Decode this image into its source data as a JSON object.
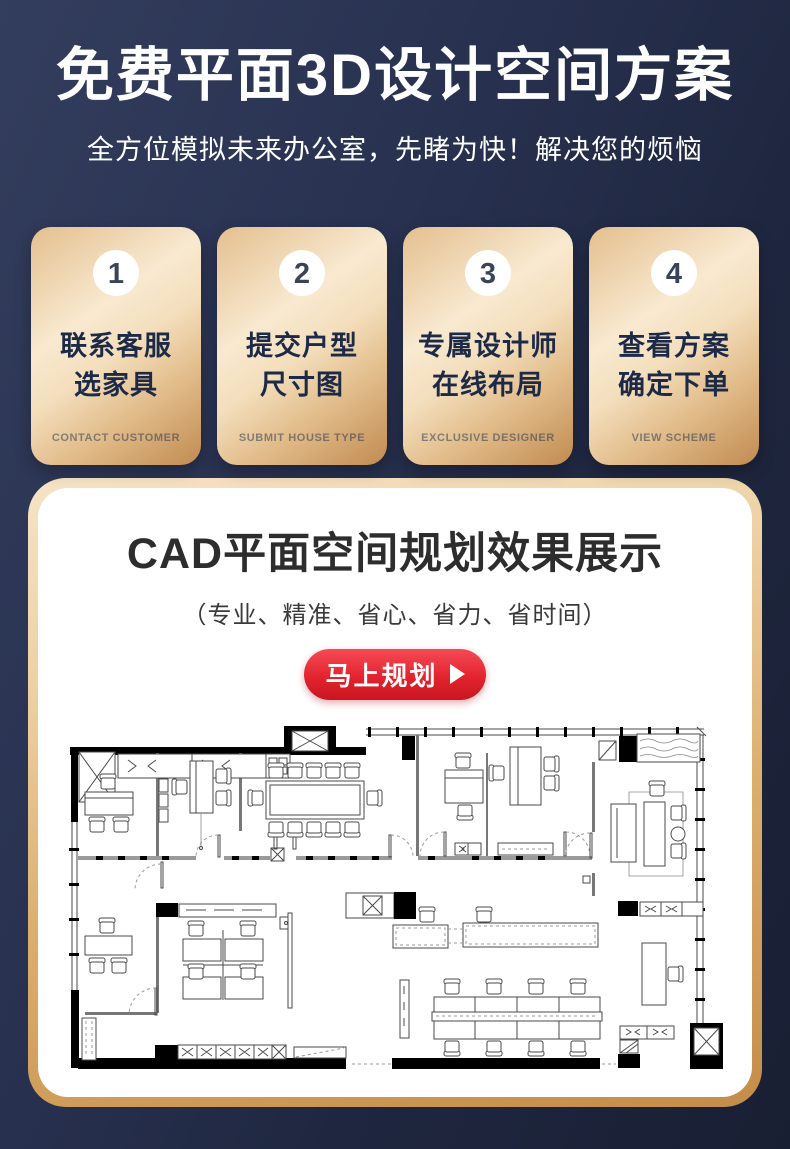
{
  "header": {
    "title": "免费平面3D设计空间方案",
    "subtitle": "全方位模拟未来办公室，先睹为快！解决您的烦恼"
  },
  "steps": {
    "items": [
      {
        "number": "1",
        "line1": "联系客服",
        "line2": "选家具",
        "subtitle": "CONTACT CUSTOMER"
      },
      {
        "number": "2",
        "line1": "提交户型",
        "line2": "尺寸图",
        "subtitle": "SUBMIT HOUSE TYPE"
      },
      {
        "number": "3",
        "line1": "专属设计师",
        "line2": "在线布局",
        "subtitle": "EXCLUSIVE DESIGNER"
      },
      {
        "number": "4",
        "line1": "查看方案",
        "line2": "确定下单",
        "subtitle": "VIEW SCHEME"
      }
    ]
  },
  "showcase": {
    "title": "CAD平面空间规划效果展示",
    "subtitle": "（专业、精准、省心、省力、省时间）",
    "button_label": "马上规划"
  },
  "icons": {
    "play": "triangle-right"
  },
  "colors": {
    "background_dark_navy": "#232c45",
    "card_gold_light": "#f8e9d0",
    "card_gold_dark": "#c18b51",
    "accent_red": "#e2242f",
    "step_text_navy": "#1d2a47"
  }
}
